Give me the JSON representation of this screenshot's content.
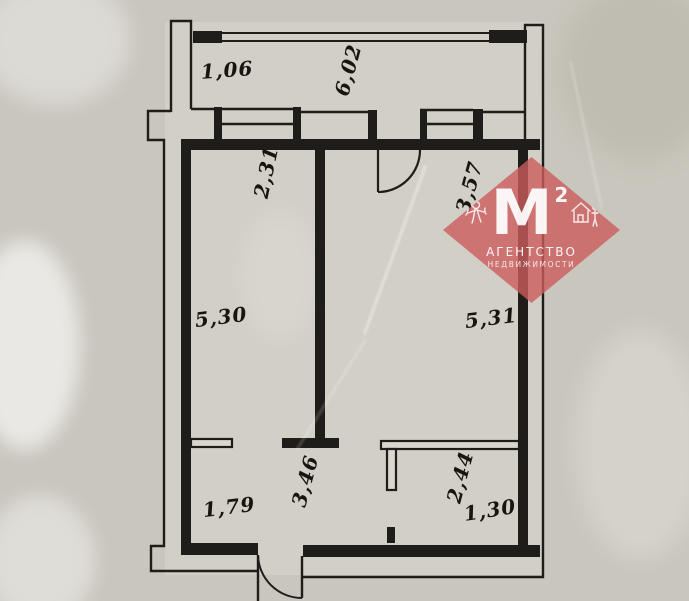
{
  "floor_plan": {
    "paper_color": "#c9c6bd",
    "ink_color": "#1f1d1a",
    "dimensions": {
      "balcony_depth": "1,06",
      "balcony_length": "6,02",
      "left_room_width": "2,31",
      "right_room_width": "3,57",
      "left_room_length": "5,30",
      "right_room_length": "5,31",
      "hallway_width": "1,79",
      "hallway_length": "3,46",
      "bathroom_length": "2,44",
      "bathroom_width": "1,30"
    }
  },
  "watermark": {
    "accent_color": "#cc5c5c",
    "monogram": "М",
    "monogram_sup": "2",
    "agency_line1": "АГЕНТСТВО",
    "agency_line2": "НЕДВИЖИМОСТИ"
  }
}
